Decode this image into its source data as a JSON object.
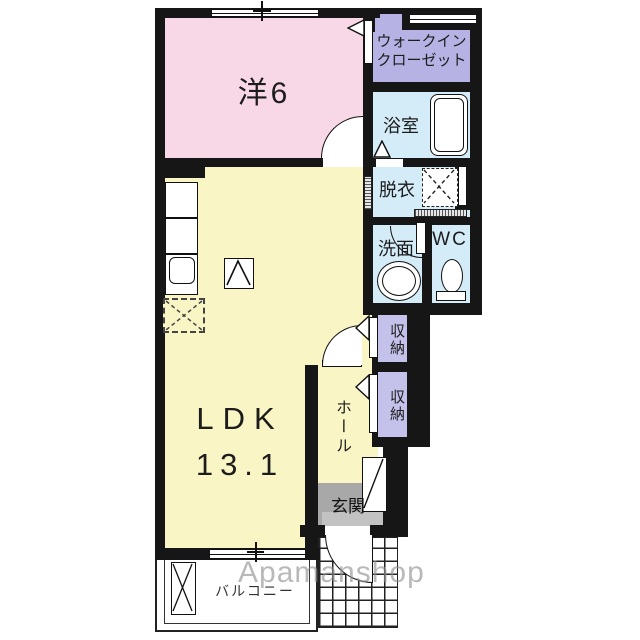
{
  "rooms": {
    "western": {
      "label": "洋6"
    },
    "walk_in_closet": {
      "line1": "ウォークイン",
      "line2": "クローゼット"
    },
    "bathroom": {
      "label": "浴室"
    },
    "dressing": {
      "label": "脱衣"
    },
    "washroom": {
      "label": "洗面"
    },
    "toilet": {
      "label": "WC"
    },
    "storage_upper": {
      "label": "収納"
    },
    "storage_lower": {
      "label": "収納"
    },
    "ldk": {
      "line1": "LDK",
      "line2": "13.1"
    },
    "hall": {
      "label": "ホール"
    },
    "entrance": {
      "label": "玄関"
    },
    "balcony": {
      "label": "バルコニー"
    }
  },
  "watermark": {
    "text": "Apamanshop"
  },
  "colors": {
    "wall": "#161616",
    "western_room": "#f8d7e7",
    "ldk": "#faf5c5",
    "closet": "#b7b2e4",
    "storage": "#c4c1ea",
    "wet_area": "#d4ecf8",
    "entrance_floor": "#a8a8a8",
    "entrance_step": "#c2c2c2",
    "watermark": "#8f8f8f"
  }
}
